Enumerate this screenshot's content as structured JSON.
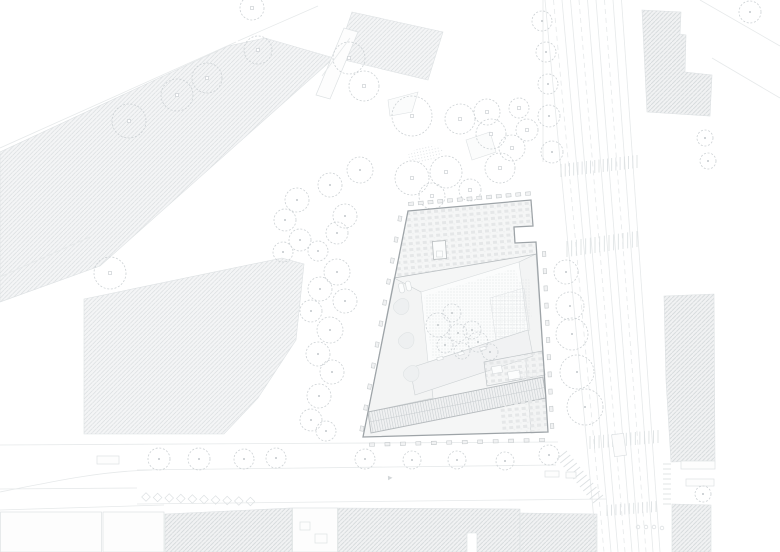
{
  "meta": {
    "kind": "architectural-site-plan",
    "canvas": {
      "w": 780,
      "h": 552
    },
    "visible_text": ""
  },
  "palette": {
    "bg": "#ffffff",
    "line_faint": "#e6e9ea",
    "line_light": "#dde1e3",
    "hatch_line_a": "#d8dcde",
    "hatch_bg_a": "#f4f5f6",
    "hatch_line_b": "#d1d6d8",
    "hatch_bg_b": "#f1f2f3",
    "tree": "#ccd1d4",
    "building_outline": "#9da3a7",
    "building_wall": "#b9bec1",
    "building_fill": "#f5f6f6",
    "roof_unit": "#e5e7e8",
    "panel_line": "#c7cccf",
    "dot": "#d9dde0"
  },
  "context_blocks": [
    {
      "name": "hatched-band-northwest",
      "tone": "A",
      "points": "0,152 228,46 265,38 334,58 100,266 0,302"
    },
    {
      "name": "hatched-block-top-center",
      "tone": "A",
      "points": "352,12 443,32 428,80 336,58"
    },
    {
      "name": "hatched-block-left",
      "tone": "A",
      "points": "84,299 282,258 304,264 296,340 258,398 224,434 84,434"
    },
    {
      "name": "hatched-block-top-right",
      "tone": "B",
      "points": "642,10 681,12 680,34 686,35 685,72 712,75 710,116 647,112"
    },
    {
      "name": "hatched-block-right",
      "tone": "B",
      "points": "664,296 714,294 715,461 671,462 666,380"
    },
    {
      "name": "hatched-block-bottom-1",
      "tone": "B",
      "points": "165,514 292,508 292,552 165,552"
    },
    {
      "name": "hatched-block-bottom-2",
      "tone": "B",
      "points": "338,508 520,509 520,552 477,552 477,533 467,533 467,552 338,552"
    },
    {
      "name": "hatched-block-bottom-3",
      "tone": "B",
      "points": "520,513 597,514 597,552 520,552"
    },
    {
      "name": "hatched-block-bottom-4",
      "tone": "B",
      "points": "672,504 711,505 711,552 672,552"
    }
  ],
  "outline_blocks": [
    {
      "x": 0.5,
      "y": 512,
      "w": 101,
      "h": 40
    },
    {
      "x": 103,
      "y": 512,
      "w": 61,
      "h": 40
    },
    {
      "x": 292.5,
      "y": 508,
      "w": 45,
      "h": 44
    }
  ],
  "roads": {
    "lines": [
      [
        0,
        148,
        236,
        42,
        0
      ],
      [
        238,
        41,
        318,
        6,
        0
      ],
      [
        0,
        277,
        92,
        236,
        0
      ],
      [
        700,
        0,
        780,
        46,
        0
      ],
      [
        712,
        58,
        780,
        98,
        0
      ],
      [
        543,
        0,
        543,
        162,
        0
      ],
      [
        0,
        445,
        558,
        442,
        0
      ],
      [
        137,
        470,
        556,
        465,
        0
      ],
      [
        0,
        489,
        137,
        488,
        0
      ],
      [
        137,
        504,
        606,
        499,
        0
      ],
      [
        0,
        510,
        164,
        505,
        0
      ]
    ],
    "curves": [
      "M0,492 C60,480 104,471 152,470"
    ],
    "tram": {
      "count": 10,
      "top_x": 545,
      "top_dx": 8.5,
      "bottom_x": 597,
      "bottom_dx": 7,
      "dashed_every": 3
    }
  },
  "crosswalks": [
    {
      "x1": 561,
      "y1": 177,
      "x2": 637,
      "y2": 168,
      "tx": 0,
      "ty": -13,
      "n": 19
    },
    {
      "x1": 567,
      "y1": 257,
      "x2": 637,
      "y2": 247,
      "tx": 0,
      "ty": -16,
      "n": 16
    },
    {
      "x1": 590,
      "y1": 449,
      "x2": 658,
      "y2": 443,
      "tx": 0,
      "ty": -13,
      "n": 16
    },
    {
      "x1": 557,
      "y1": 459,
      "x2": 593,
      "y2": 503,
      "tx": 10,
      "ty": -8,
      "n": 12
    },
    {
      "x1": 607,
      "y1": 516,
      "x2": 656,
      "y2": 512,
      "tx": 0,
      "ty": -11,
      "n": 12
    },
    {
      "x1": 663,
      "y1": 464,
      "x2": 663,
      "y2": 504,
      "tx": 8,
      "ty": 0,
      "n": 9
    }
  ],
  "chevron_parking": {
    "x": 146,
    "y": 497,
    "n": 10,
    "step": 11.6,
    "size": 8.6
  },
  "trees": {
    "groups": [
      {
        "name": "avenue-trees",
        "style": "park",
        "items": [
          [
            129,
            121,
            17
          ],
          [
            177,
            95,
            16
          ],
          [
            207,
            78,
            15
          ],
          [
            258,
            50,
            14
          ],
          [
            252,
            8,
            12
          ],
          [
            110,
            273,
            16
          ]
        ]
      },
      {
        "name": "mid-parcel-trees",
        "style": "park",
        "items": [
          [
            349,
            58,
            16
          ],
          [
            364,
            86,
            15
          ]
        ]
      },
      {
        "name": "park-cluster",
        "style": "park",
        "items": [
          [
            412,
            116,
            20
          ],
          [
            460,
            119,
            15
          ],
          [
            487,
            112,
            13
          ],
          [
            491,
            134,
            15
          ],
          [
            512,
            148,
            13
          ],
          [
            500,
            168,
            15
          ],
          [
            446,
            172,
            16
          ],
          [
            412,
            178,
            17
          ],
          [
            432,
            196,
            13
          ],
          [
            470,
            190,
            11
          ],
          [
            527,
            130,
            11
          ],
          [
            519,
            108,
            10
          ]
        ]
      },
      {
        "name": "left-tree-column",
        "style": "street",
        "items": [
          [
            360,
            170,
            13
          ],
          [
            330,
            185,
            12
          ],
          [
            297,
            200,
            12
          ],
          [
            285,
            220,
            11
          ],
          [
            345,
            216,
            12
          ],
          [
            337,
            233,
            11
          ],
          [
            300,
            240,
            11
          ],
          [
            283,
            252,
            10
          ],
          [
            318,
            251,
            10
          ],
          [
            337,
            272,
            13
          ],
          [
            320,
            289,
            12
          ],
          [
            345,
            301,
            12
          ],
          [
            311,
            311,
            11
          ],
          [
            330,
            330,
            13
          ],
          [
            318,
            354,
            12
          ],
          [
            332,
            372,
            12
          ],
          [
            319,
            396,
            12
          ],
          [
            311,
            420,
            11
          ],
          [
            326,
            431,
            10
          ]
        ]
      },
      {
        "name": "tram-street-trees",
        "style": "street",
        "items": [
          [
            542,
            21,
            10
          ],
          [
            546,
            52,
            10
          ],
          [
            548,
            84,
            10
          ],
          [
            549,
            116,
            11
          ],
          [
            552,
            152,
            11
          ],
          [
            705,
            138,
            8
          ],
          [
            708,
            161,
            8
          ],
          [
            750,
            12,
            11
          ]
        ]
      },
      {
        "name": "right-tree-column",
        "style": "street",
        "items": [
          [
            566,
            272,
            12
          ],
          [
            570,
            306,
            14
          ],
          [
            572,
            334,
            16
          ],
          [
            577,
            372,
            17
          ],
          [
            585,
            407,
            18
          ],
          [
            549,
            455,
            10
          ],
          [
            703,
            494,
            8
          ]
        ]
      },
      {
        "name": "bottom-road-trees",
        "style": "street",
        "items": [
          [
            159,
            459,
            11
          ],
          [
            199,
            459,
            11
          ],
          [
            244,
            459,
            10
          ],
          [
            276,
            458,
            10
          ],
          [
            365,
            459,
            10
          ],
          [
            412,
            460,
            9
          ],
          [
            457,
            460,
            9
          ],
          [
            505,
            461,
            9
          ]
        ]
      },
      {
        "name": "courtyard-trees",
        "style": "courtyard",
        "items": [
          [
            438,
            325,
            12
          ],
          [
            458,
            333,
            9
          ],
          [
            472,
            330,
            9
          ],
          [
            445,
            345,
            8
          ],
          [
            462,
            351,
            8
          ],
          [
            478,
            342,
            10
          ],
          [
            490,
            352,
            8
          ],
          [
            452,
            313,
            9
          ]
        ]
      }
    ]
  },
  "park": {
    "beds": [
      "388,100 418,92 412,112 390,116",
      "466,140 490,132 496,152 472,160"
    ],
    "dot_patch": {
      "cx": 425,
      "cy": 154,
      "rx": 18,
      "ry": 7,
      "rot": -12
    }
  },
  "small_structures": {
    "narrow_building": {
      "points": "316,95 344,28 358,32 330,99",
      "inner": [
        [
          322,
          76,
          350,
          38
        ]
      ]
    },
    "misc_rects": [
      {
        "x": 97,
        "y": 456,
        "w": 22,
        "h": 8,
        "rot": 0
      },
      {
        "x": 613,
        "y": 434,
        "w": 12,
        "h": 22,
        "rot": -8
      },
      {
        "x": 681,
        "y": 461,
        "w": 34,
        "h": 8,
        "rot": 0
      },
      {
        "x": 686,
        "y": 479,
        "w": 28,
        "h": 7,
        "rot": 0
      },
      {
        "x": 545,
        "y": 471,
        "w": 14,
        "h": 6,
        "rot": 0
      },
      {
        "x": 566,
        "y": 472,
        "w": 10,
        "h": 6,
        "rot": 0
      },
      {
        "x": 300,
        "y": 522,
        "w": 10,
        "h": 8,
        "rot": 0
      },
      {
        "x": 315,
        "y": 534,
        "w": 12,
        "h": 9,
        "rot": 0
      }
    ],
    "court_rects": [
      {
        "x": 437,
        "y": 357,
        "w": 6,
        "h": 3,
        "rot": -14
      },
      {
        "x": 458,
        "y": 352,
        "w": 6,
        "h": 3,
        "rot": -14
      },
      {
        "x": 480,
        "y": 347,
        "w": 6,
        "h": 3,
        "rot": -14
      }
    ],
    "bollards": [
      [
        638,
        527
      ],
      [
        646,
        527
      ],
      [
        654,
        527
      ],
      [
        662,
        528
      ]
    ],
    "arrows": [
      {
        "x": 388,
        "y": 478,
        "rot": -3
      }
    ]
  },
  "building": {
    "outer": "M408,211 L531,200 L533,226 L514,227 L515,243 L536,242 L548,432 L363,437 Z",
    "top_wing": "M408,211 L531,200 L533,226 L514,227 L515,243 L536,242 L537,254 L394,278 Z",
    "divider": "M394,278 L537,254",
    "left_wing": "M394,278 L421,292 L433,398 L368,412 L363,437 Z",
    "right_wing": "M536,254 L548,432 L531,433 L519,262 Z",
    "courtyard": "M421,292 L519,262 L528,330 L428,362 Z",
    "terrace_dots": "M424,296 L516,268 L525,332 L432,358 Z",
    "court_grid": "M490,298 L524,288 L530,330 L496,340 Z",
    "inner_band": "M410,368 L528,330 L533,356 L415,395 Z",
    "se_block": "M484,362 L542,351 L545,375 L487,386 Z",
    "se_white_rects": [
      {
        "x": 492,
        "y": 366,
        "w": 10,
        "h": 7,
        "rot": -10
      },
      {
        "x": 508,
        "y": 371,
        "w": 12,
        "h": 8,
        "rot": -10
      }
    ],
    "se_grid": "M518,372 L538,368 L540,379 L520,383 Z",
    "solar_strip": "M368,412 L543,377 L546,398 L371,433 Z",
    "solar_midline": [
      369.5,
      422,
      544.5,
      387.5
    ],
    "se_lower_units": "M500,404 L545,396 L547,428 L503,434 Z",
    "rw_dot_strip": "M515,282 L529,278 L532,318 L518,322 Z",
    "rw_units": "M522,376 L537,373 L540,430 L526,432 Z",
    "skylight": {
      "x": 433,
      "y": 241,
      "w": 13,
      "h": 18,
      "rot": -4,
      "inner": {
        "x": 436.5,
        "y": 251,
        "w": 6,
        "h": 6
      }
    },
    "pills": [
      [
        399,
        283
      ],
      [
        406,
        281
      ]
    ],
    "blobs": [
      [
        397,
        301
      ],
      [
        402,
        335
      ],
      [
        407,
        368
      ]
    ],
    "teeth_edges": [
      {
        "x1": 411,
        "y1": 207.8,
        "x2": 528,
        "y2": 197.6,
        "ox": 0,
        "oy": -4,
        "n": 13
      },
      {
        "x1": 404.5,
        "y1": 219,
        "x2": 366.5,
        "y2": 429,
        "ox": -4.6,
        "oy": -0.4,
        "n": 11
      },
      {
        "x1": 539.5,
        "y1": 254,
        "x2": 547.5,
        "y2": 426,
        "ox": 4.6,
        "oy": 0,
        "n": 11
      },
      {
        "x1": 372,
        "y1": 440.6,
        "x2": 542,
        "y2": 436,
        "ox": 0,
        "oy": 4,
        "n": 12
      }
    ]
  }
}
